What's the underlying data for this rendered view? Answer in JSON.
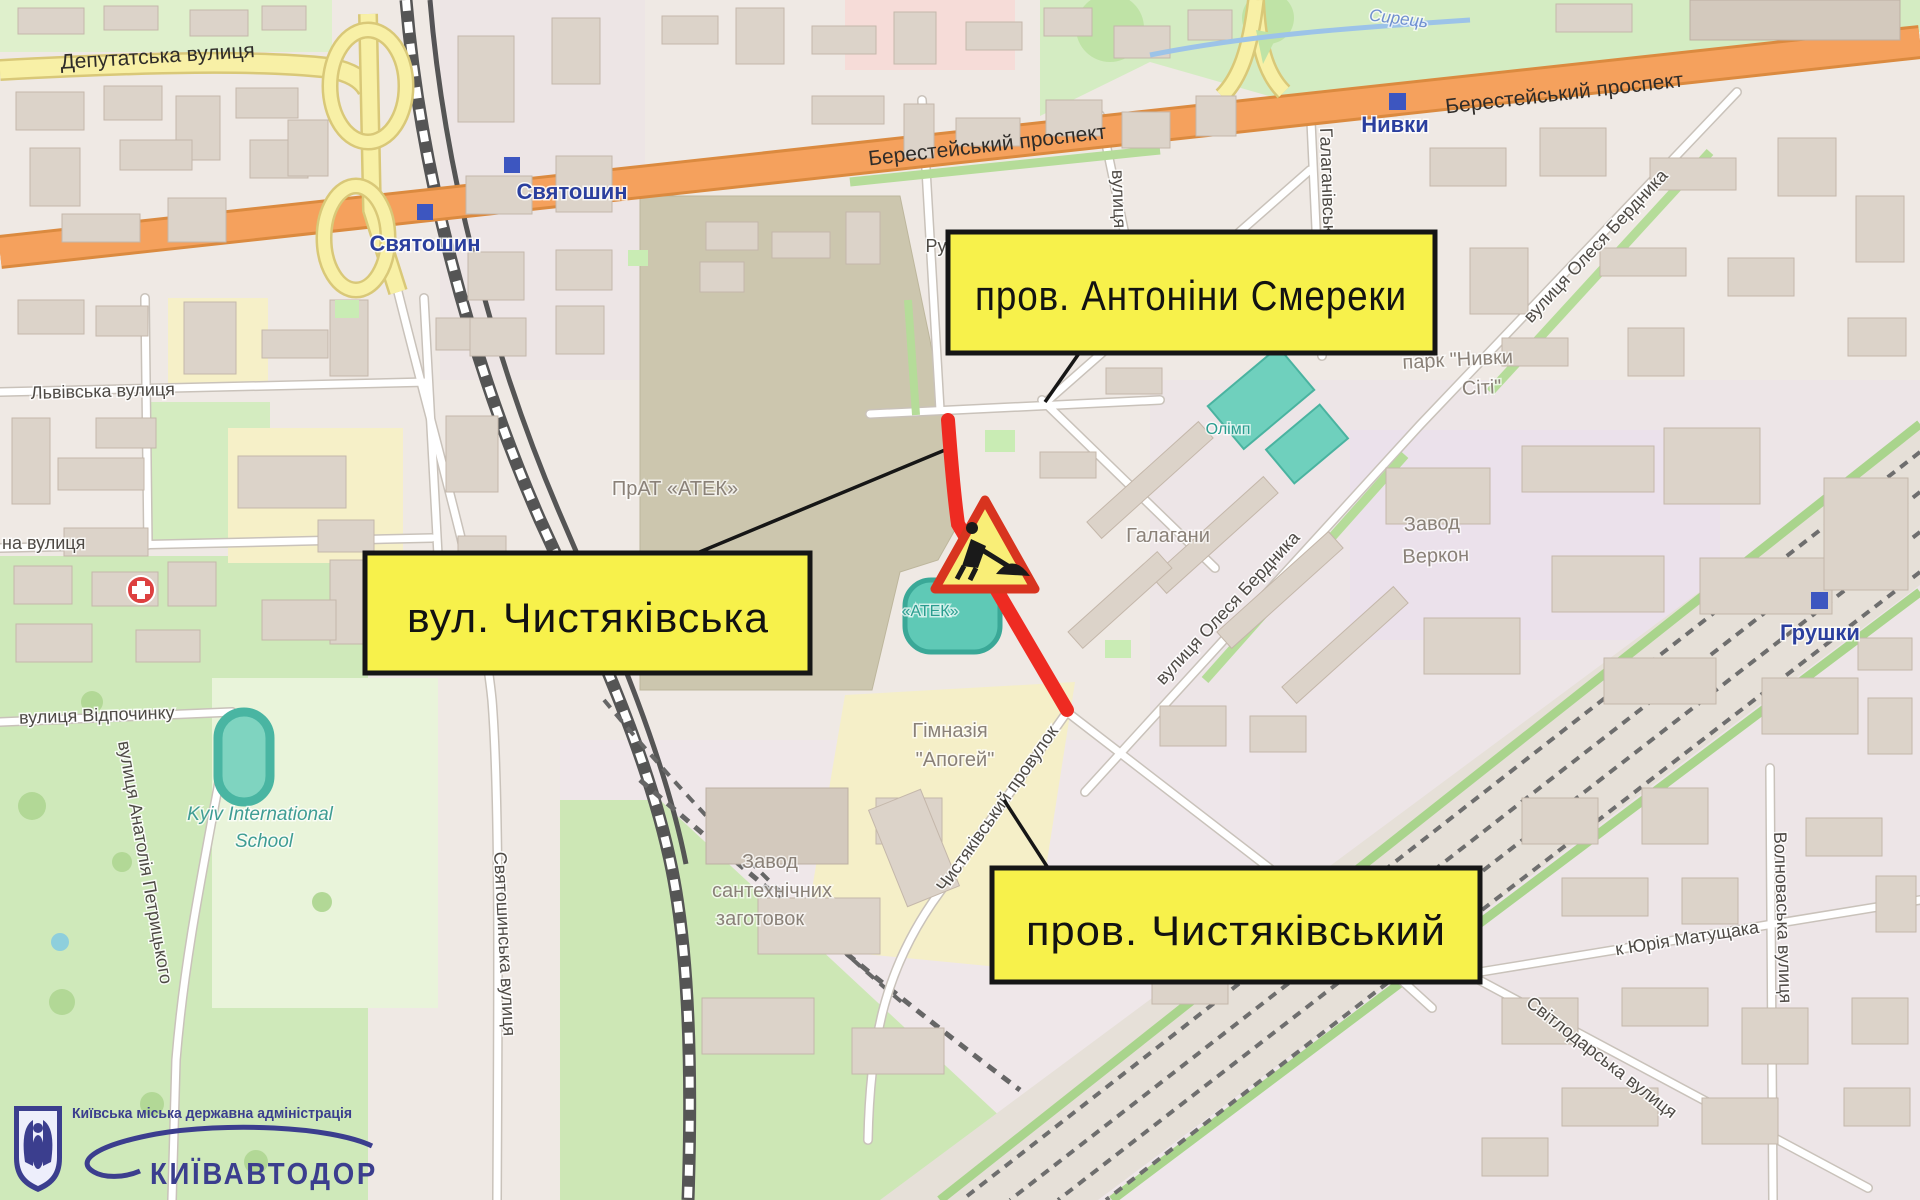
{
  "boxes": {
    "antoniny": "пров. Антоніни Смереки",
    "chystiakivska": "вул. Чистяківська",
    "chystiakivskyi": "пров. Чистяківський"
  },
  "metro": {
    "sviatoshyn": "Святошин",
    "nyvky": "Нивки",
    "hrushky": "Грушки"
  },
  "streets": {
    "deputatska": "Депутатська вулиця",
    "beresteiskyi": "Берестейський проспект",
    "lvivska": "Львівська вулиця",
    "partial_na": "на вулиця",
    "vidpochynku": "вулиця Відпочинку",
    "petrytskoho": "вулиця Анатолія Петрицького",
    "sviatoshynska": "Святошинська вулиця",
    "berdnyka": "вулиця Олеся Бердника",
    "halahanivska": "Галаганівська",
    "vulytsia": "вулиця",
    "ru_partial": "Ру",
    "chystiakivskyi_prov": "Чистяківський провулок",
    "matushchaka": "к Юрія Матущака",
    "svitlodarska": "Світлодарська вулиця",
    "volnovaska": "Волноваська вулиця"
  },
  "places": {
    "atek": "ПрАТ «АТЕК»",
    "atek_stadium": "«АТЕК»",
    "halahany": "Галагани",
    "olimp": "Олімп",
    "park_nyvky": [
      "парк \"Нивки",
      "Сіті\""
    ],
    "zavod_verkon": [
      "Завод",
      "Веркон"
    ],
    "zavod_san": [
      "Завод",
      "сантехнічних",
      "заготовок"
    ],
    "himnaziia": [
      "Гімназія",
      "\"Апогей\""
    ],
    "school": [
      "Kyiv International",
      "School"
    ],
    "syrets": "Сирець"
  },
  "logo": {
    "admin": "Київська  міська  державна  адміністрація",
    "name": "КИЇВАВТОДОР"
  },
  "colors": {
    "closure_red": "#ee2b22",
    "box_yellow": "#f7f14b",
    "metro_blue": "#2b3f9e",
    "trunk_orange": "#f5a15d",
    "logo_blue": "#3b3e8e"
  }
}
